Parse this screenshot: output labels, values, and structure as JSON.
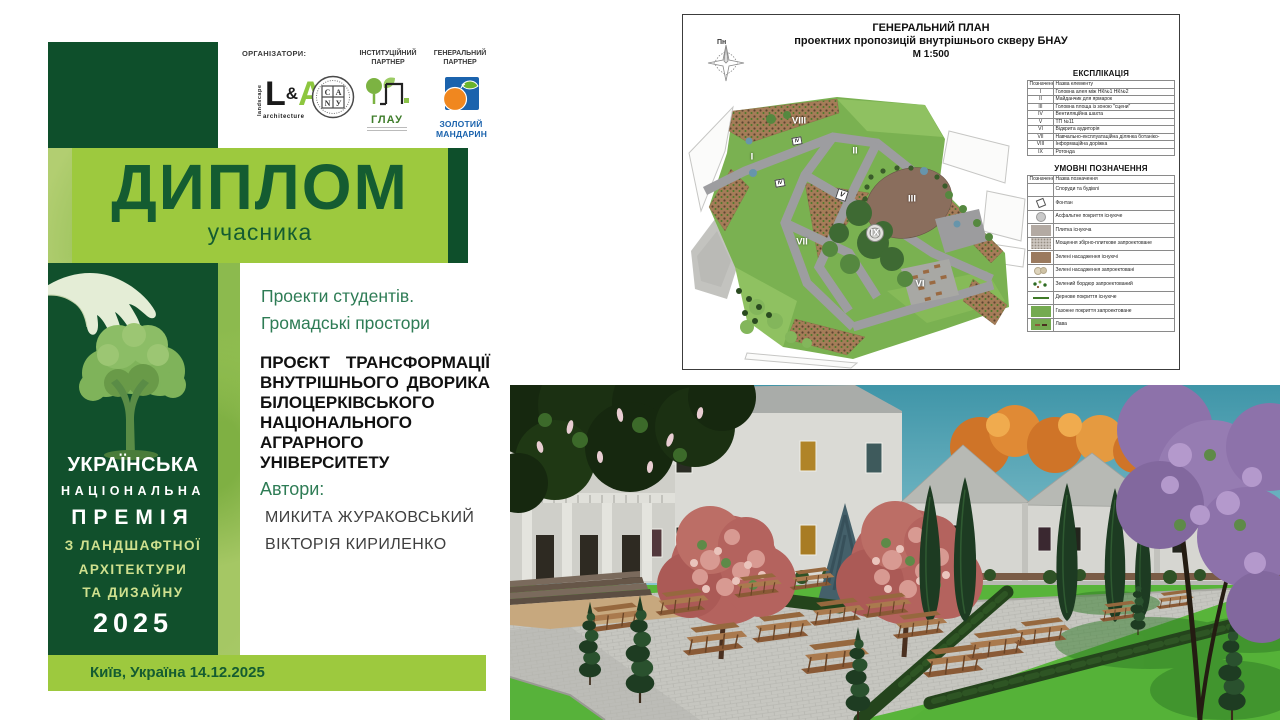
{
  "diploma": {
    "organizers_label": "ОРГАНІЗАТОРИ:",
    "institutional_partner_label": "ІНСТИТУЦІЙНИЙ ПАРТНЕР",
    "general_partner_label": "ГЕНЕРАЛЬНИЙ ПАРТНЕР",
    "logo_la": {
      "landscape": "landscape",
      "l": "L",
      "amp": "&",
      "a": "A",
      "architecture": "architecture"
    },
    "logo_canu": {
      "top_left": "С",
      "top_right": "А",
      "bottom_left": "N",
      "bottom_right": "У"
    },
    "logo_glau": {
      "name": "ГЛАУ"
    },
    "logo_mandarin": {
      "line1": "ЗОЛОТИЙ",
      "line2": "МАНДАРИН"
    },
    "title": "ДИПЛОМ",
    "subtitle": "учасника",
    "category": [
      "Проекти студентів.",
      "Громадські  простори"
    ],
    "project_title": "ПРОЄКТ ТРАНСФОРМАЦІЇ ВНУТРІШНЬОГО ДВОРИКА БІЛОЦЕРКІВСЬКОГО НАЦІОНАЛЬНОГО АГРАРНОГО УНІВЕРСИТЕТУ",
    "authors_label": "Автори:",
    "authors": [
      "МИКИТА ЖУРАКОВСЬКИЙ",
      "ВІКТОРІЯ КИРИЛЕНКО"
    ],
    "award": {
      "line1": "УКРАЇНСЬКА",
      "line2": "НАЦІОНАЛЬНА",
      "line3": "ПРЕМІЯ",
      "line4": "З ЛАНДШАФТНОЇ",
      "line5": "АРХІТЕКТУРИ",
      "line6": "ТА ДИЗАЙНУ",
      "year": "2025"
    },
    "footer": "Київ, Україна  14.12.2025"
  },
  "plan": {
    "title1": "ГЕНЕРАЛЬНИЙ ПЛАН",
    "title2": "проектних пропозицій внутрішнього скверу БНАУ",
    "title3": "М 1:500",
    "compass_label": "Пн",
    "explication": {
      "title": "ЕКСПЛІКАЦІЯ",
      "col1": "Позначення",
      "col2": "Назва елементу",
      "rows": [
        {
          "num": "I",
          "name": "Головна алея між НК№1 НК№2"
        },
        {
          "num": "II",
          "name": "Майданчик для ярмарок"
        },
        {
          "num": "III",
          "name": "Головна площа із зоною \"сцени\""
        },
        {
          "num": "IV",
          "name": "Вентиляційна шахта"
        },
        {
          "num": "V",
          "name": "ТП №11"
        },
        {
          "num": "VI",
          "name": "Відкрита аудиторія"
        },
        {
          "num": "VII",
          "name": "Навчально-експлуатаційна ділянка ботаніко-"
        },
        {
          "num": "VIII",
          "name": "Інформаційна доріжка"
        },
        {
          "num": "IX",
          "name": "Ротонда"
        }
      ]
    },
    "legend": {
      "title": "УМОВНІ ПОЗНАЧЕННЯ",
      "col1": "Позначення",
      "col2": "Назва позначення",
      "rows": [
        {
          "sym": "sym-building",
          "name": "Споруди та будівлі"
        },
        {
          "sym": "sym-fountain",
          "name": "Фонтан"
        },
        {
          "sym": "sym-asphalt",
          "name": "Асфальтне покриття існуюче"
        },
        {
          "sym": "sym-tile",
          "name": "Плитка існуюча"
        },
        {
          "sym": "sym-paving",
          "name": "Мощення збірно-плиткове запроектоване"
        },
        {
          "sym": "sym-green-exist",
          "name": "Зелені насадження існуючі"
        },
        {
          "sym": "sym-green-new",
          "name": "Зелені насадження запроектовані"
        },
        {
          "sym": "sym-border",
          "name": "Зелений бордюр запроектований"
        },
        {
          "sym": "sym-turf",
          "name": "Дернове покриття існуюче"
        },
        {
          "sym": "sym-lawn",
          "name": "Газонне покриття запроектоване"
        },
        {
          "sym": "sym-bench",
          "name": "Лава"
        }
      ]
    },
    "map_labels": [
      {
        "t": "VIII",
        "x": 112,
        "y": 30
      },
      {
        "t": "II",
        "x": 168,
        "y": 60
      },
      {
        "t": "I",
        "x": 65,
        "y": 66
      },
      {
        "t": "III",
        "x": 225,
        "y": 108
      },
      {
        "t": "IX",
        "x": 188,
        "y": 142
      },
      {
        "t": "VII",
        "x": 115,
        "y": 151
      },
      {
        "t": "VI",
        "x": 233,
        "y": 193
      }
    ],
    "map_markers": [
      {
        "t": "IV",
        "cls": "marker-iv",
        "x": 110,
        "y": 50
      },
      {
        "t": "IV",
        "cls": "marker-iv",
        "x": 93,
        "y": 92
      },
      {
        "t": "V",
        "cls": "marker-v",
        "x": 155,
        "y": 104
      }
    ]
  }
}
